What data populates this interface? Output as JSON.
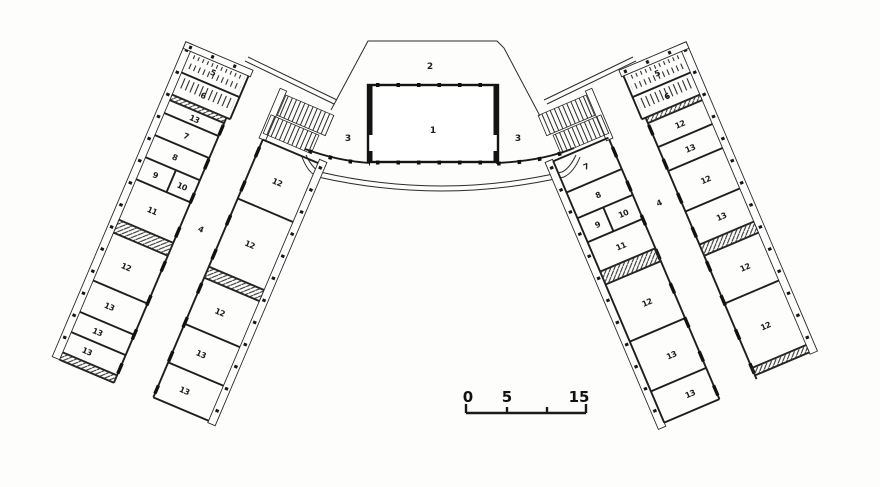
{
  "plan": {
    "central": {
      "hall": "1",
      "stage": "2",
      "corridor_left": "3",
      "corridor_right": "3"
    },
    "left_wing": {
      "corridor": "4",
      "outer": [
        "5",
        "6",
        "13",
        "7",
        "8",
        "9",
        "10",
        "11",
        "12",
        "13",
        "13",
        "13"
      ],
      "inner": [
        "12",
        "12",
        "12",
        "13",
        "13"
      ]
    },
    "right_wing": {
      "corridor": "4",
      "outer": [
        "5",
        "6",
        "12",
        "13",
        "12",
        "13",
        "12",
        "12"
      ],
      "inner": [
        "7",
        "8",
        "9",
        "10",
        "11",
        "12",
        "13",
        "13"
      ]
    },
    "scale_bar": {
      "labels": [
        "0",
        "5",
        "15"
      ]
    },
    "colors": {
      "ink": "#1c1c1c",
      "paper": "#fdfdfb"
    }
  }
}
